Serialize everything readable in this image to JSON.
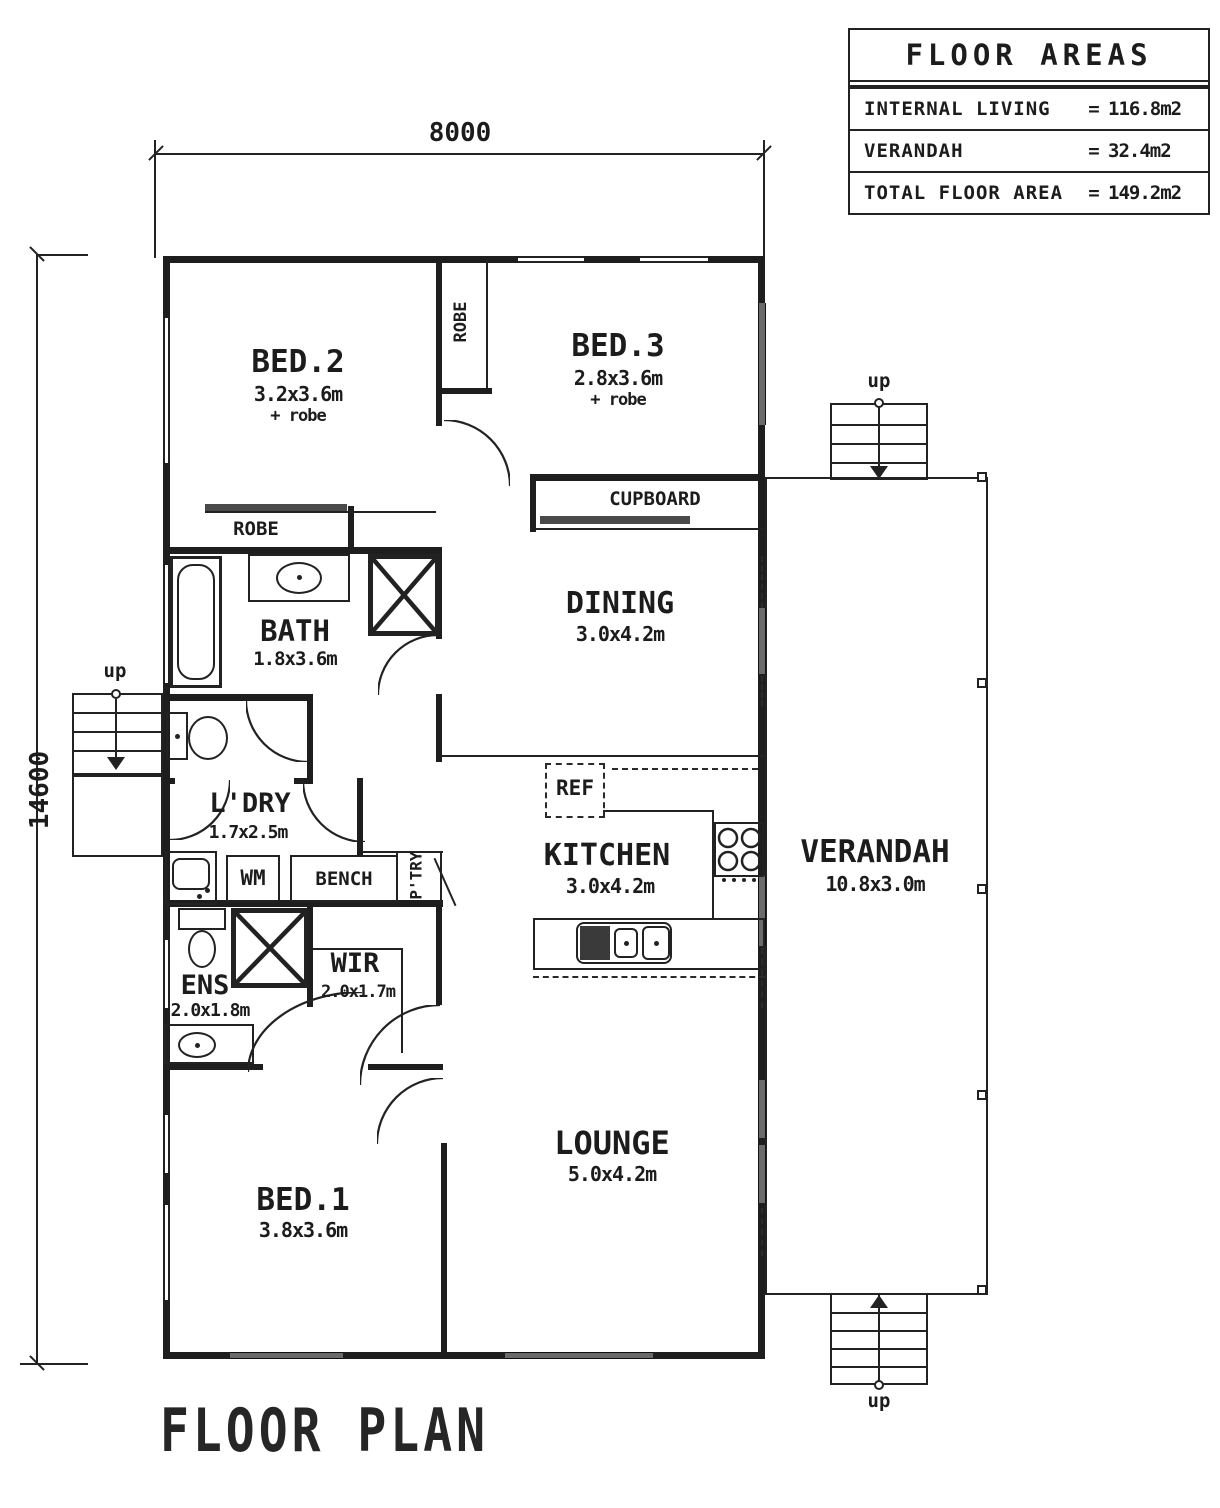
{
  "title": "FLOOR PLAN",
  "floor_areas": {
    "title": "FLOOR AREAS",
    "rows": [
      {
        "label": "INTERNAL LIVING",
        "eq": "=",
        "value": "116.8m2"
      },
      {
        "label": "VERANDAH",
        "eq": "=",
        "value": "32.4m2"
      },
      {
        "label": "TOTAL FLOOR AREA",
        "eq": "=",
        "value": "149.2m2"
      }
    ]
  },
  "dimensions": {
    "width": "8000",
    "height": "14600"
  },
  "rooms": {
    "bed2": {
      "name": "BED.2",
      "size": "3.2x3.6m",
      "extra": "+ robe"
    },
    "bed3": {
      "name": "BED.3",
      "size": "2.8x3.6m",
      "extra": "+ robe"
    },
    "dining": {
      "name": "DINING",
      "size": "3.0x4.2m"
    },
    "bath": {
      "name": "BATH",
      "size": "1.8x3.6m"
    },
    "ldry": {
      "name": "L'DRY",
      "size": "1.7x2.5m"
    },
    "kitchen": {
      "name": "KITCHEN",
      "size": "3.0x4.2m"
    },
    "verandah": {
      "name": "VERANDAH",
      "size": "10.8x3.0m"
    },
    "ens": {
      "name": "ENS",
      "size": "2.0x1.8m"
    },
    "wir": {
      "name": "WIR",
      "size": "2.0x1.7m"
    },
    "bed1": {
      "name": "BED.1",
      "size": "3.8x3.6m"
    },
    "lounge": {
      "name": "LOUNGE",
      "size": "5.0x4.2m"
    }
  },
  "labels": {
    "robe_closet": "ROBE",
    "robe_bed2": "ROBE",
    "cupboard": "CUPBOARD",
    "ref": "REF",
    "wm": "WM",
    "bench": "BENCH",
    "ptry": "P'TRY",
    "up": "up"
  },
  "colors": {
    "wall": "#1e1e1e",
    "window": "#6b6b6b",
    "paper": "#ffffff"
  }
}
